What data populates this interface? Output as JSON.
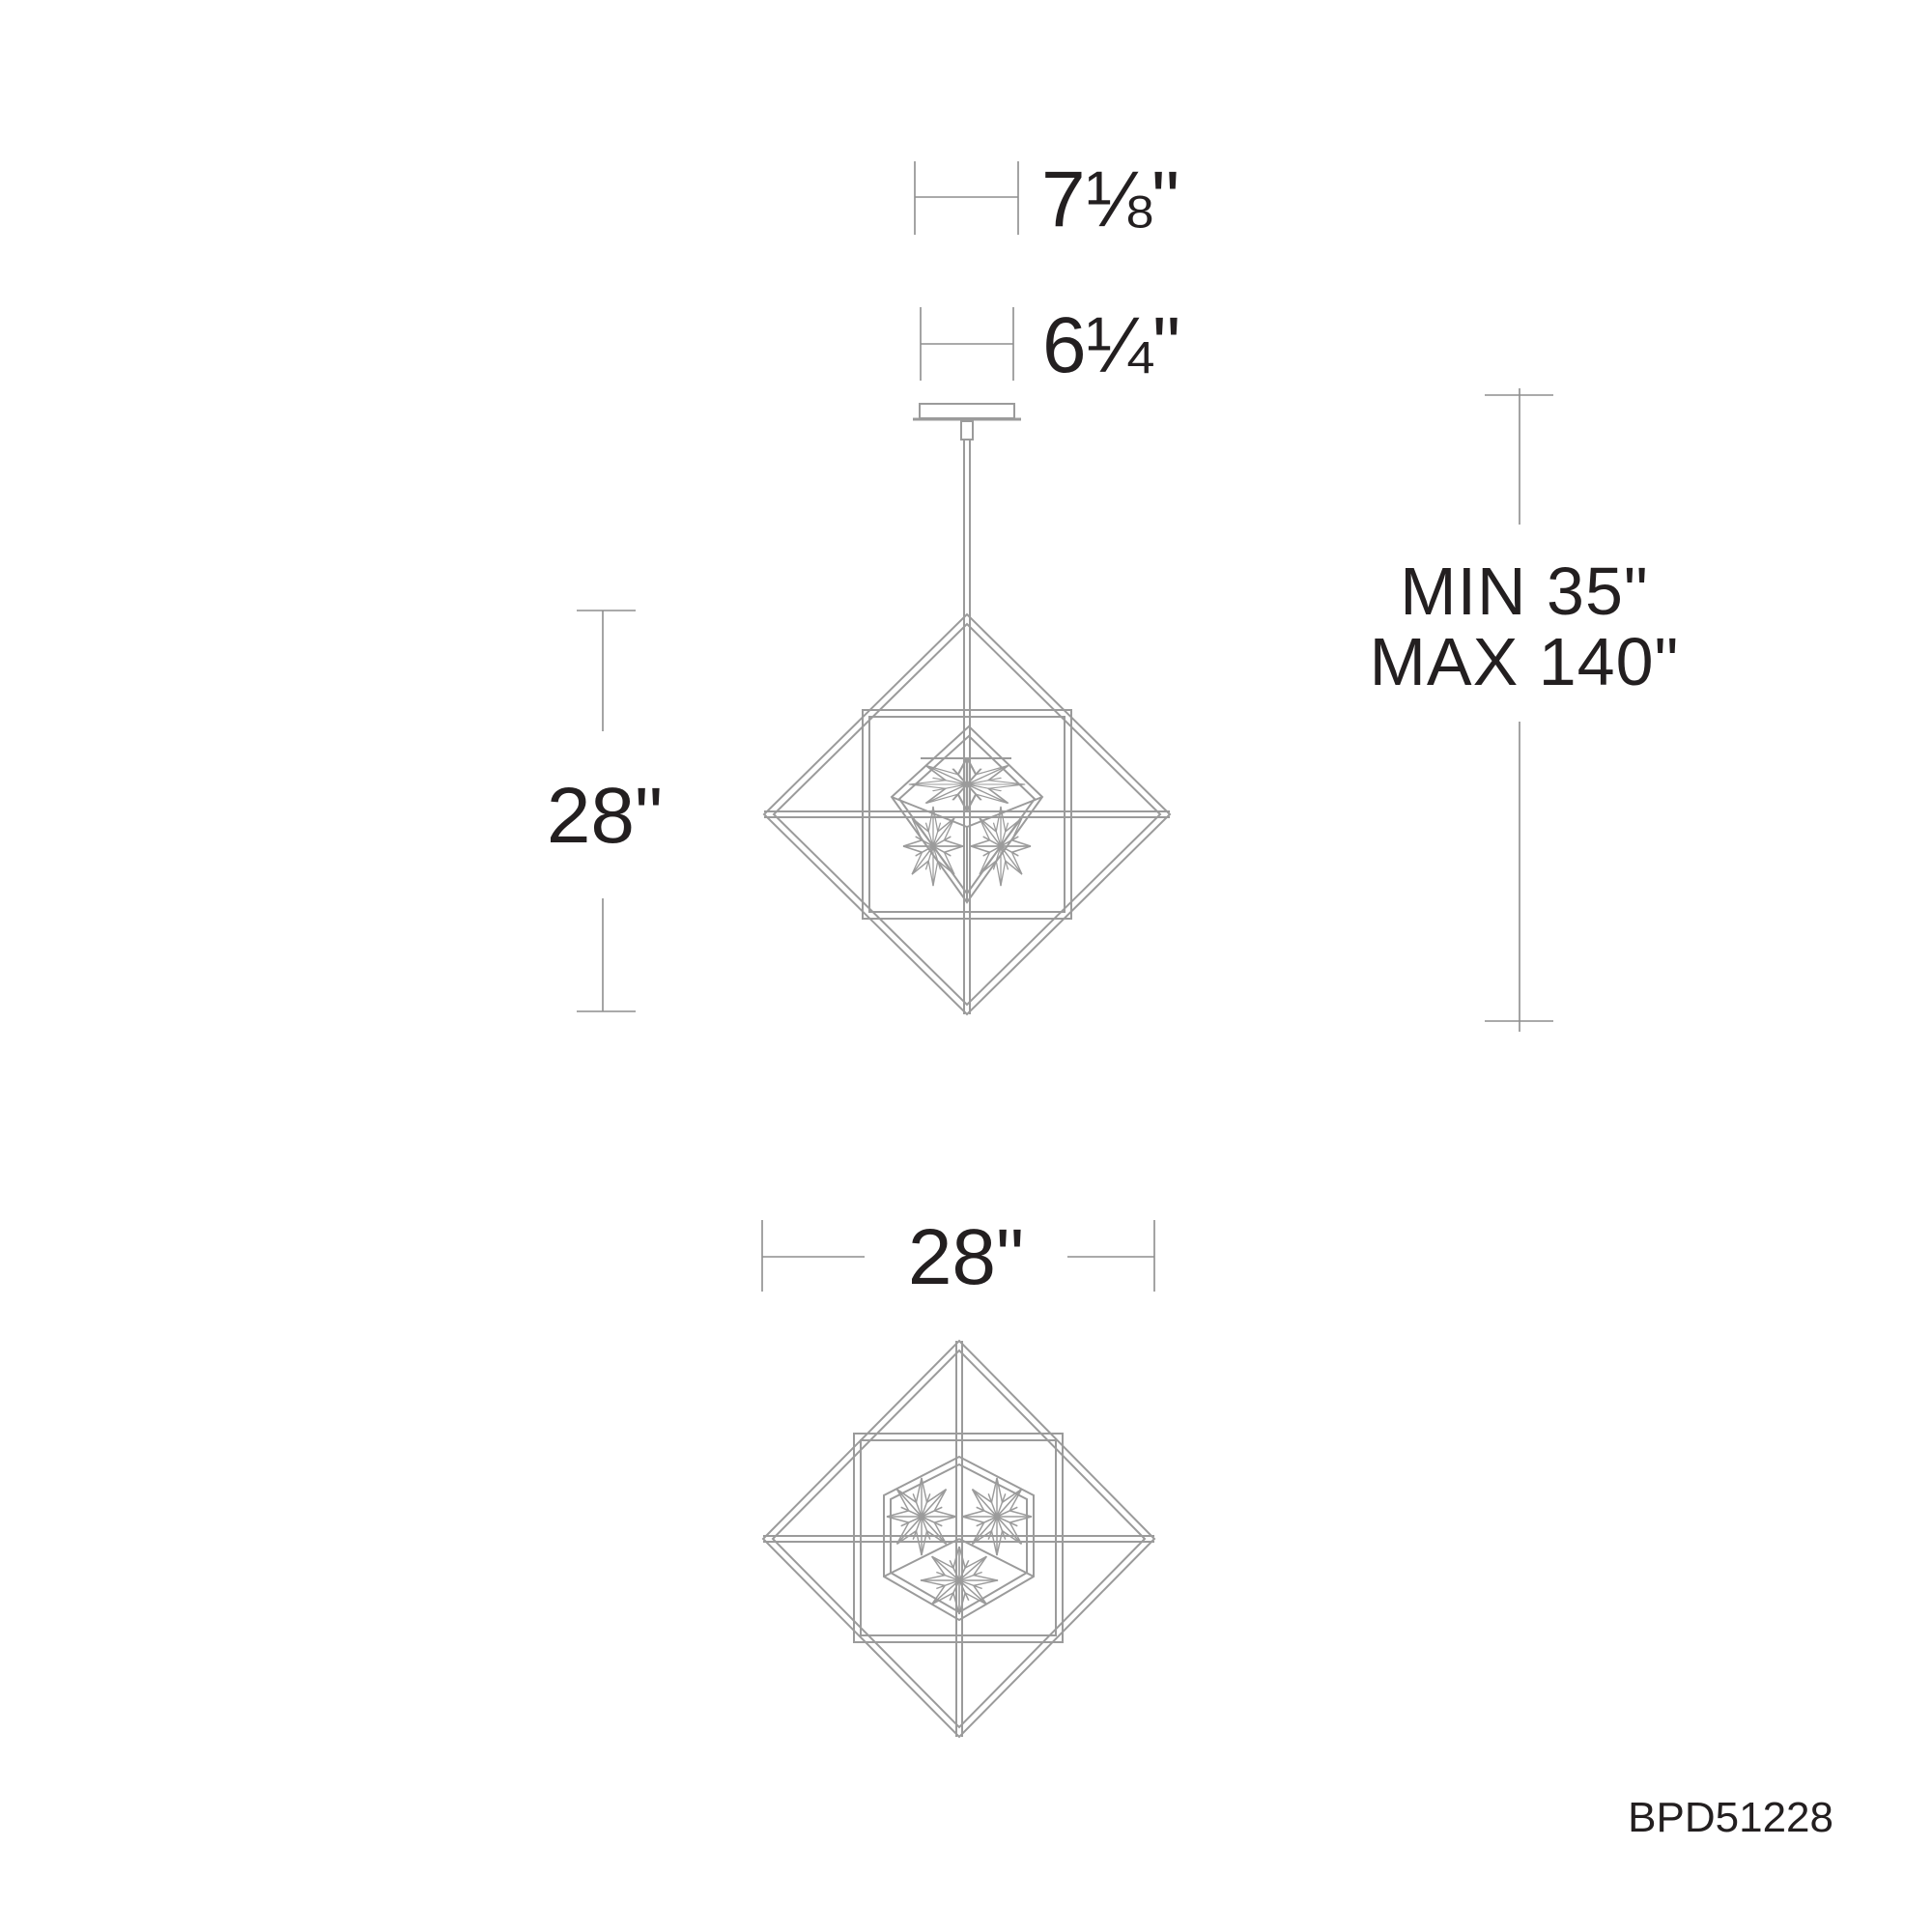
{
  "product": {
    "code": "BPD51228"
  },
  "dimensions": {
    "canopy_overall_width": "7⅛\"",
    "canopy_width": "6¼\"",
    "fixture_height": "28\"",
    "suspension_min": "MIN 35\"",
    "suspension_max": "MAX 140\"",
    "fixture_width": "28\""
  },
  "colors": {
    "background": "#ffffff",
    "fixture_line": "#9b9b9b",
    "dimension_line": "#8e8e8e",
    "text": "#231f20"
  }
}
